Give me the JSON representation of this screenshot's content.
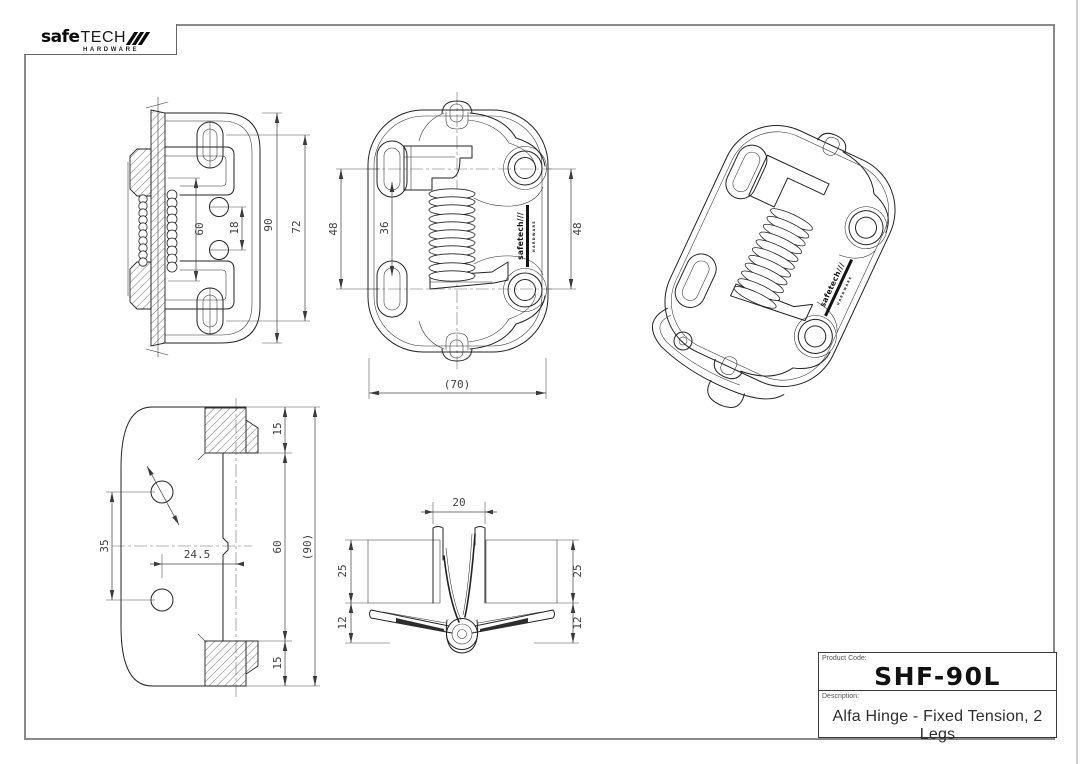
{
  "logo": {
    "word_main": "safe",
    "word_sub": "tech",
    "tagline": "HARDWARE"
  },
  "brand_stamp": {
    "text": "safetech///",
    "tagline": "HARDWARE"
  },
  "title_block": {
    "product_code_label": "Product Code:",
    "product_code": "SHF-90L",
    "description_label": "Description:",
    "description": "Alfa Hinge - Fixed Tension, 2 Legs"
  },
  "views": {
    "side_section": {
      "dims": {
        "spring_span": "60",
        "hole_pitch": "18",
        "overall_height": "90",
        "slot_pitch": "72"
      }
    },
    "front": {
      "dims": {
        "slot_pitch": "48",
        "slot_span": "36",
        "hole_pitch": "48",
        "overall_width": "(70)"
      }
    },
    "plan": {
      "dims": {
        "top_pad": "15",
        "hole_pitch": "35",
        "hole_offset": "24.5",
        "inner_height": "60",
        "overall_height": "(90)",
        "bottom_pad": "15"
      }
    },
    "end": {
      "dims": {
        "leg_gap": "20",
        "left_leg_depth": "25",
        "left_leaf_drop": "12",
        "right_leg_depth": "25",
        "right_leaf_drop": "12"
      }
    }
  }
}
